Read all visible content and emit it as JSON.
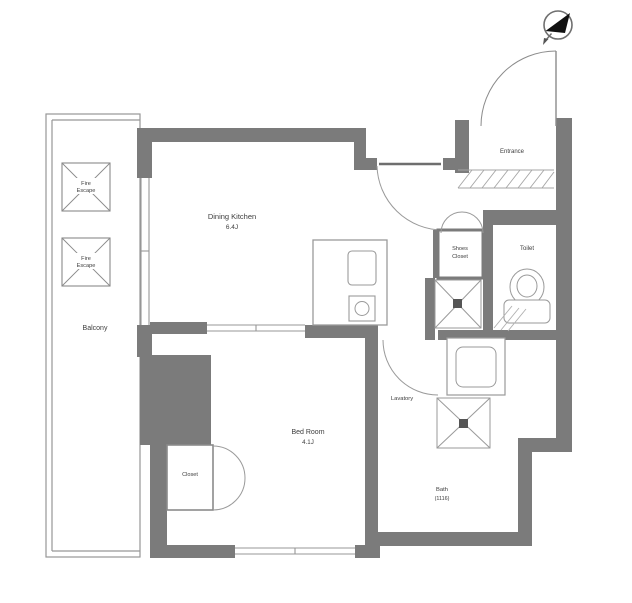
{
  "colors": {
    "wall": "#7b7b7b",
    "line": "#979797",
    "fixture_line": "#9a9a9a",
    "text": "#3c3c3c",
    "compass": "#111111"
  },
  "rooms": {
    "balcony": {
      "name": "Balcony"
    },
    "dining_kitchen": {
      "name": "Dining Kitchen",
      "size": "6.4J"
    },
    "bed_room": {
      "name": "Bed Room",
      "size": "4.1J"
    },
    "entrance": {
      "name": "Entrance"
    },
    "toilet": {
      "name": "Toilet"
    },
    "lavatory": {
      "name": "Lavatory"
    },
    "bath": {
      "name": "Bath",
      "size": "(1116)"
    },
    "closet": {
      "name": "Closet"
    },
    "shoes_closet": {
      "line1": "Shoes",
      "line2": "Closet"
    },
    "fire_escape": {
      "line1": "Fire",
      "line2": "Escape"
    }
  }
}
